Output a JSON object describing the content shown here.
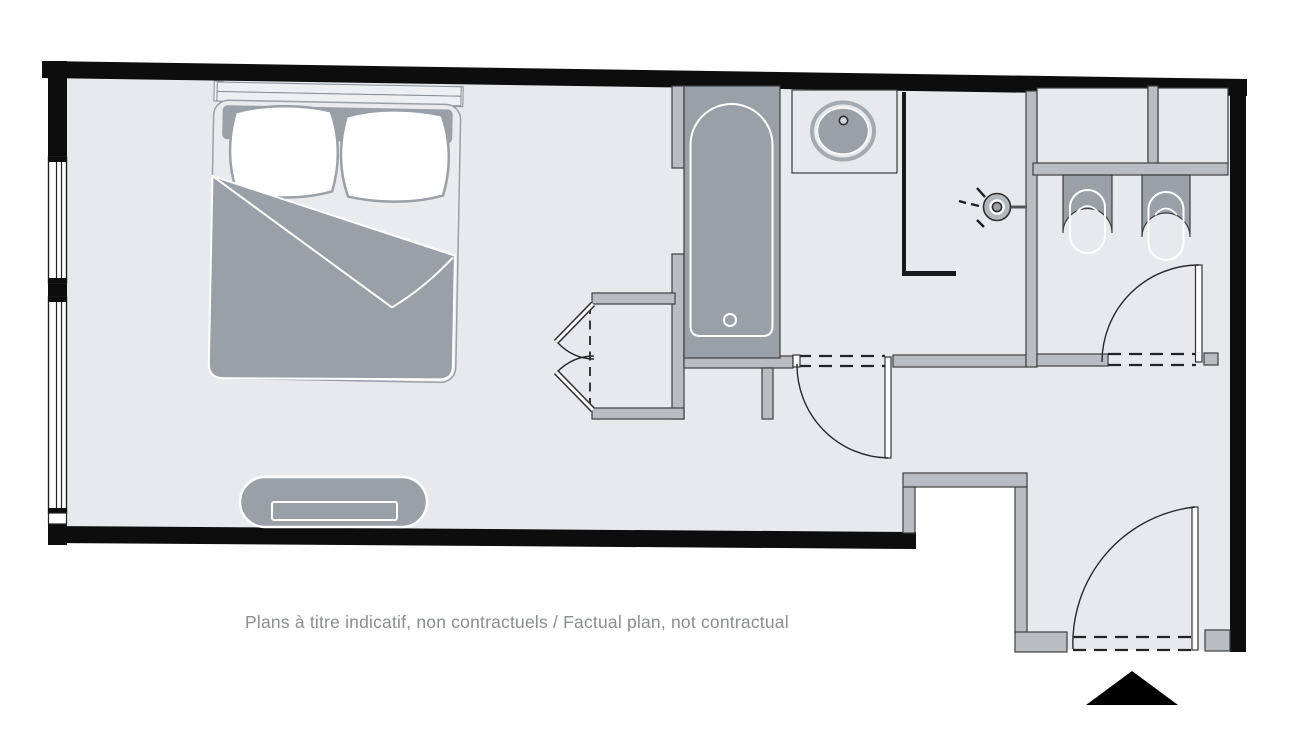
{
  "caption": {
    "text": "Plans à titre indicatif, non contractuels / Factual plan, not contractual",
    "color": "#8a8d91"
  },
  "palette": {
    "background": "#ffffff",
    "floor": "#e7e9ed",
    "exterior_wall": "#0d0d0d",
    "interior_wall": "#b9bdc3",
    "fixture_gray": "#9aa0a8",
    "fixture_outline": "#3f3f3f",
    "fixture_highlight": "#ffffff"
  },
  "plan": {
    "entrance_marker": "black-triangle",
    "rooms": [
      "bedroom",
      "bathroom",
      "shower-room",
      "wc",
      "entry-hall"
    ],
    "fixtures": [
      "double-bed",
      "headboard",
      "pillow-left",
      "pillow-right",
      "duvet",
      "bench",
      "bifold-wardrobe",
      "bathtub",
      "washbasin",
      "shower-head",
      "wall-hung-bidet",
      "wall-hung-toilet",
      "window-left-1",
      "window-left-2",
      "bathroom-door",
      "wc-door",
      "entry-door"
    ]
  }
}
